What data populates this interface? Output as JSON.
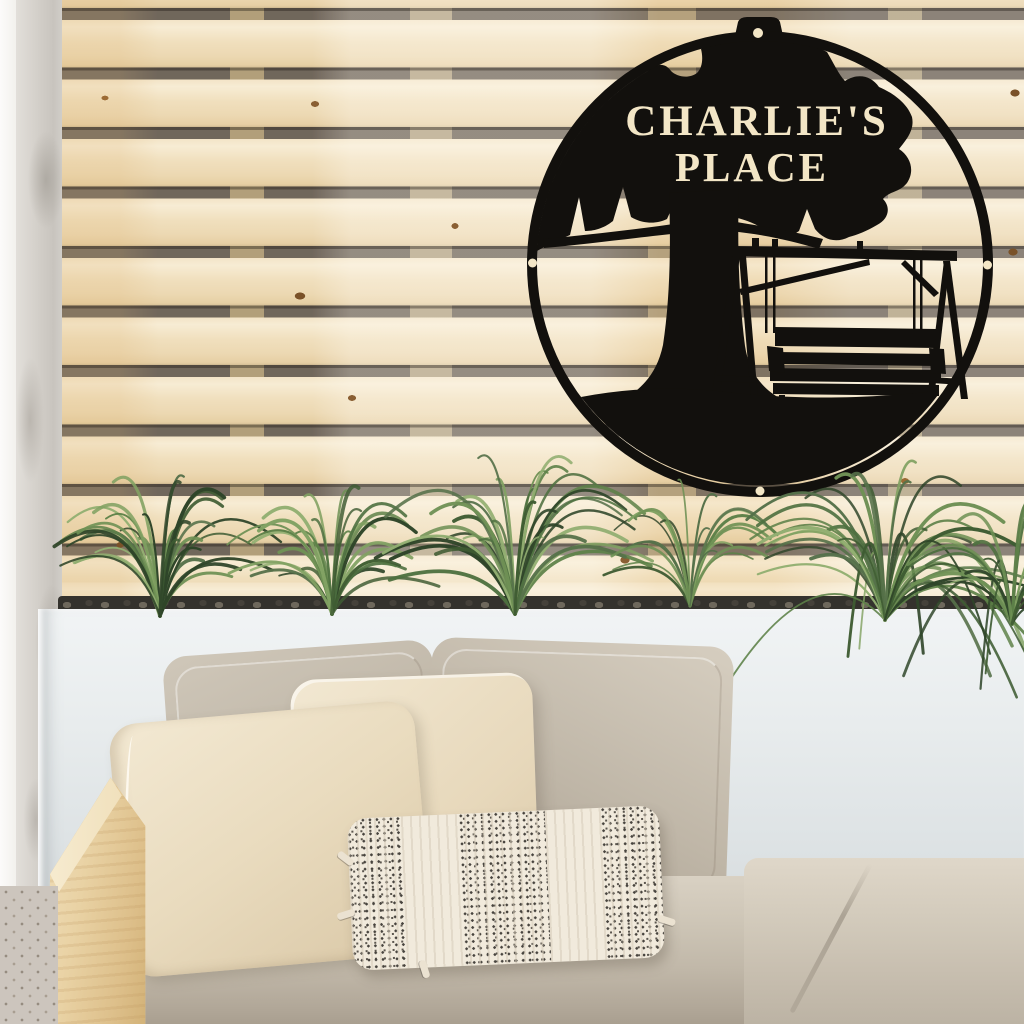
{
  "sign": {
    "line1": "CHARLIE'S",
    "line2": "PLACE",
    "metal_color": "#12100d",
    "cutout_color": "#f3e6c6",
    "motif": "oak tree with hanging porch swing on grass mound inside ring",
    "mount_holes": 4
  },
  "palette": {
    "wood_slat": "#f0dfbf",
    "slat_gap": "#756b60",
    "concrete_wall": "#d4d0ca",
    "planter_white": "#e9edee",
    "pebbles": "#34322d",
    "plant_green": "#4e7040",
    "pillow_cream": "#eee3cb",
    "pillow_greige": "#c2b9aa",
    "seat_cushion": "#c7beaf",
    "arm_wood": "#e9d2a4"
  }
}
